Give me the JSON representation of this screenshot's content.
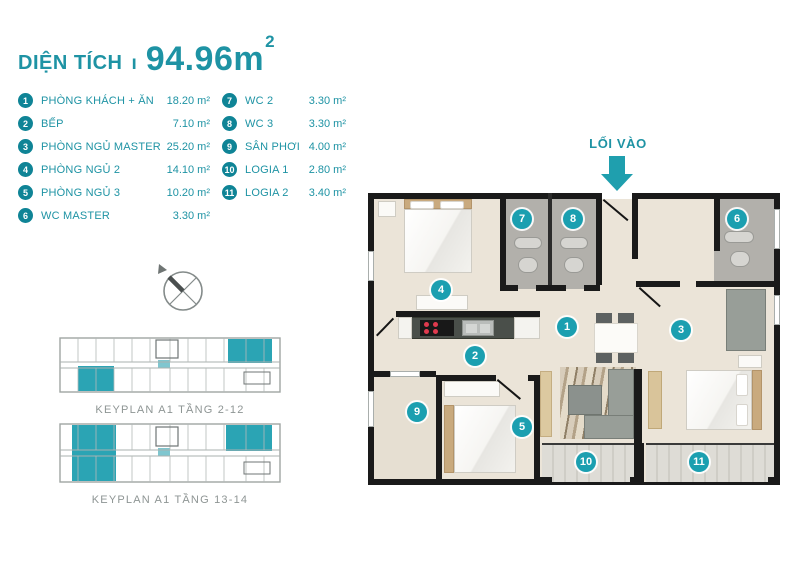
{
  "header": {
    "label": "DIỆN TÍCH",
    "separator": "ı",
    "value": "94.96m",
    "sup": "2"
  },
  "legend": {
    "items": [
      {
        "num": "1",
        "label": "PHÒNG KHÁCH + ĂN",
        "area": "18.20 m²"
      },
      {
        "num": "2",
        "label": "BẾP",
        "area": "7.10 m²"
      },
      {
        "num": "3",
        "label": "PHÒNG NGỦ MASTER",
        "area": "25.20 m²"
      },
      {
        "num": "4",
        "label": "PHÒNG NGỦ 2",
        "area": "14.10 m²"
      },
      {
        "num": "5",
        "label": "PHÒNG NGỦ 3",
        "area": "10.20 m²"
      },
      {
        "num": "6",
        "label": "WC MASTER",
        "area": "3.30 m²"
      },
      {
        "num": "7",
        "label": "WC 2",
        "area": "3.30 m²"
      },
      {
        "num": "8",
        "label": "WC 3",
        "area": "3.30 m²"
      },
      {
        "num": "9",
        "label": "SÂN PHƠI",
        "area": "4.00 m²"
      },
      {
        "num": "10",
        "label": "LOGIA 1",
        "area": "2.80 m²"
      },
      {
        "num": "11",
        "label": "LOGIA 2",
        "area": "3.40 m²"
      }
    ]
  },
  "entry": {
    "label": "LỐI VÀO"
  },
  "keyplans": [
    {
      "caption": "KEYPLAN A1 TẦNG 2-12"
    },
    {
      "caption": "KEYPLAN A1 TẦNG 13-14"
    }
  ],
  "plan": {
    "markers": [
      "1",
      "2",
      "3",
      "4",
      "5",
      "6",
      "7",
      "8",
      "9",
      "10",
      "11"
    ]
  },
  "colors": {
    "teal_text": "#1e93a4",
    "marker": "#1b9fb0",
    "keyplan_highlight": "#2ba4b4"
  }
}
